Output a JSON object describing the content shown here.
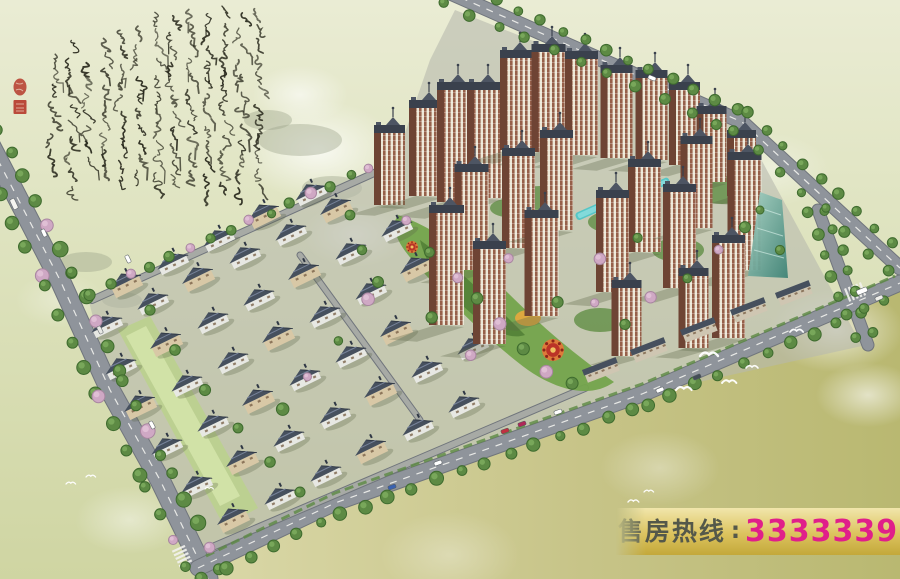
{
  "title": "residential compound aerial rendering",
  "banner": {
    "label": "售房热线",
    "separator": ":",
    "phone": "3333339",
    "bg_top": "#f1e6ab",
    "bg_mid": "#dcc35e",
    "bg_bottom": "#c3a83a",
    "label_color": "#54584a",
    "phone_color": "#e01f8a"
  },
  "calligraphy": {
    "description": "Thirteen vertical columns of illegible cursive grass-script Chinese calligraphy brushed in dark ink across the pale sky at upper left, with two red artist seals",
    "ink_color": "#26261a",
    "seal_color": "#b5392a",
    "seal_count": 2,
    "columns": 13
  },
  "scene": {
    "description": "Bird's-eye master-plan rendering: striped high-rise towers in the upper right, diagonal rows of pitched-roof villas in the lower left, tree-lined boulevards around the site, a central landscaped spine with a red circular plaza, orange garden and aqua pools, a green glass building at right, cars on the roads and white birds over the olive ground at lower right",
    "colors": {
      "sky_top": "#eaecd4",
      "sky_mid": "#dde2bd",
      "ground": "#cfd5a2",
      "ground_pale": "#dad8a8",
      "ground_olive": "#b9b871",
      "site_paving": "#b7b9ad",
      "road": "#8f949b",
      "road_minor": "#a7aaa5",
      "road_edge": "#70757c",
      "marking": "#f2f2ee",
      "tower_stripe_dark": "#96604a",
      "tower_stripe_light": "#ece7d6",
      "tower_side": "#6e4434",
      "tower_roof": "#3a414d",
      "tower_roof_light": "#4d5563",
      "villa_roof": "#46505e",
      "villa_roof_dark": "#2f3744",
      "villa_wall": "#e7e8e3",
      "walkup_wall": "#d8c8a6",
      "tree_green": "#5d8a44",
      "tree_dark": "#3e6b2e",
      "blossom_pink": "#cfa8c4",
      "blossom_edge": "#a886a0",
      "lawn": "#74a44c",
      "lawn_light": "#bcd18f",
      "garden_dark": "#4e7c33",
      "pool": "#55c6c6",
      "plaza_ring": "#dd7b3a",
      "plaza_core": "#bb3327",
      "garden_orange": "#e3a83e",
      "glass_building": "#6fae9e",
      "shadow": "#5d6648",
      "mist": "#ffffff",
      "bird": "#ffffff"
    },
    "counts": {
      "towers": 25,
      "villa_rows": 7,
      "low_rise_slabs": 5,
      "birds": 10,
      "cars": 15,
      "pools": 2,
      "plazas": 2
    }
  }
}
